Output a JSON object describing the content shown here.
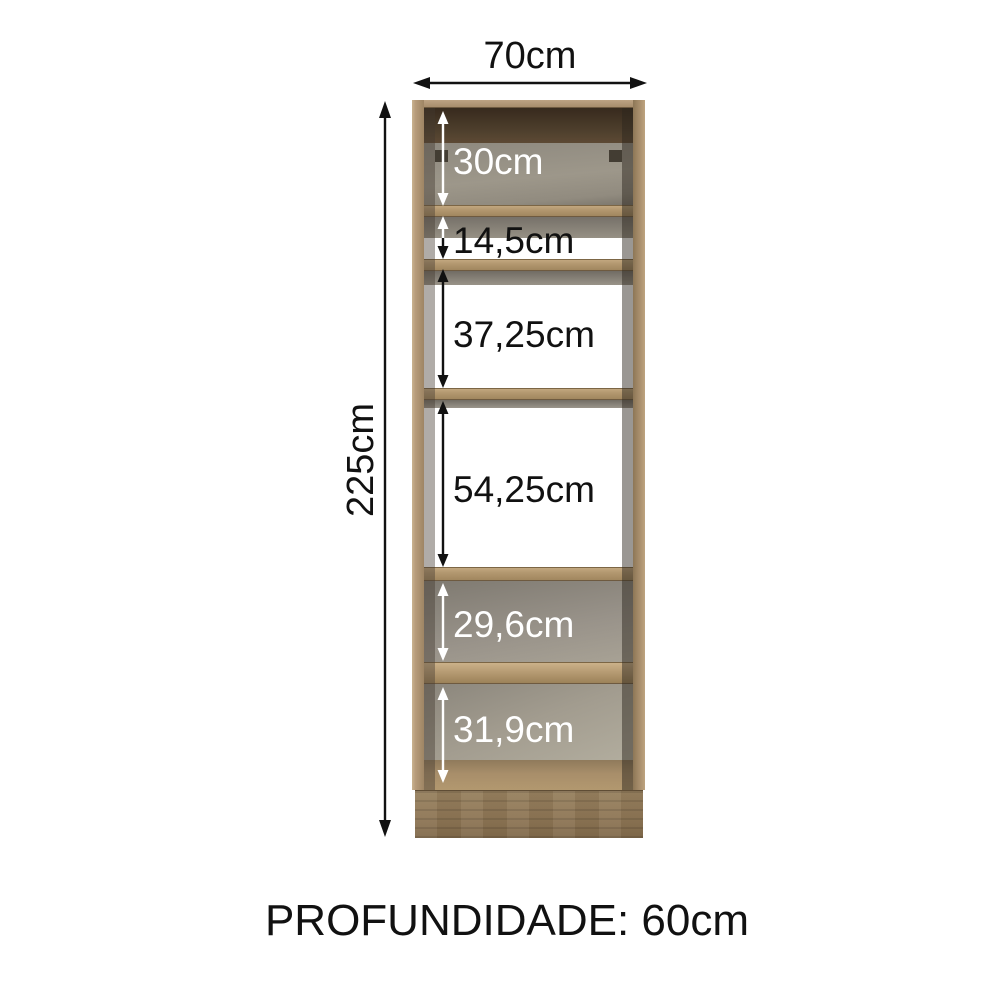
{
  "dimensions": {
    "width_label": "70cm",
    "height_label": "225cm",
    "depth_caption": "PROFUNDIDADE: 60cm",
    "compartments": [
      {
        "label": "30cm"
      },
      {
        "label": "14,5cm"
      },
      {
        "label": "37,25cm"
      },
      {
        "label": "54,25cm"
      },
      {
        "label": "29,6cm"
      },
      {
        "label": "31,9cm"
      }
    ]
  },
  "colors": {
    "page_bg": "#ffffff",
    "wood": "#ab9070",
    "wood_light": "#c3a987",
    "wood_dark": "#8d7554",
    "panel_gray": "#9b958a",
    "interior_dark": "#4a3826",
    "annotation_black": "#111111",
    "annotation_white": "#ffffff"
  }
}
